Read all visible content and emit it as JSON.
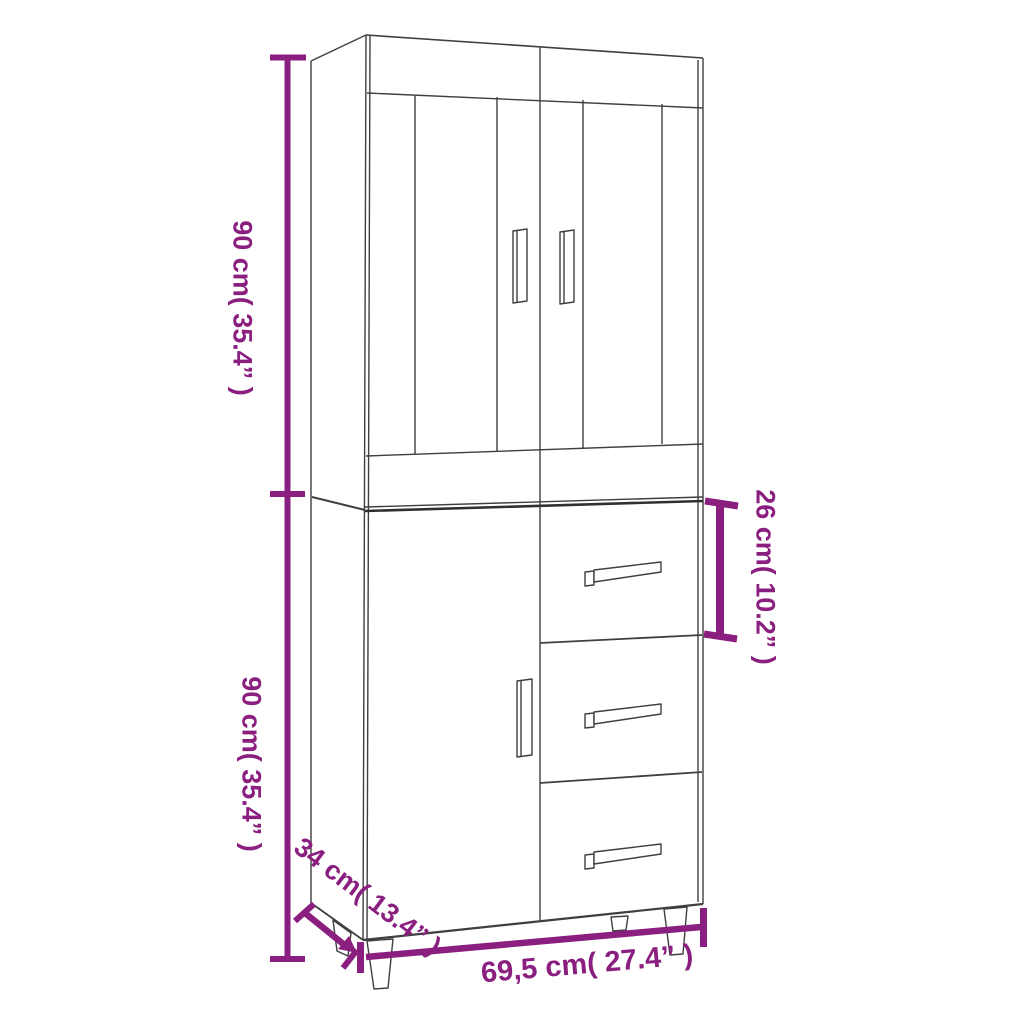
{
  "diagram": {
    "title": "Highboard dimension diagram",
    "product": "Tall cabinet: two framed glass doors on top section; one door and three drawers on bottom section; tapered legs",
    "style": {
      "dimension_color": "#8A1F80",
      "outline_color": "#3F3F3F",
      "background_color": "#FFFFFF"
    },
    "dimensions": {
      "upper_section_height": "90 cm( 35.4” )",
      "lower_section_height": "90 cm( 35.4” )",
      "top_drawer_height": "26 cm( 10.2” )",
      "depth": "34 cm( 13.4” )",
      "width": "69,5 cm( 27.4” )"
    }
  }
}
